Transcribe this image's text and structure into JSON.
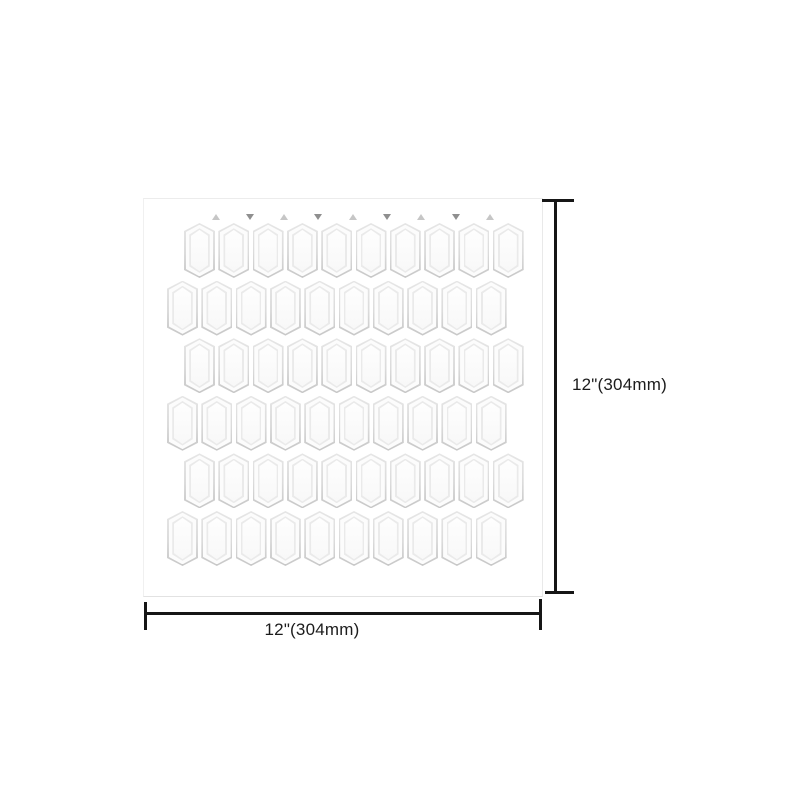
{
  "product": {
    "image_type": "tile-sheet-dimension-diagram",
    "dimension_labels": {
      "height": "12\"(304mm)",
      "width": "12\"(304mm)"
    }
  },
  "tile_sheet": {
    "rows": 6,
    "columns": 10,
    "tile_shape": "elongated-hexagon-picket",
    "markers": [
      "up",
      "down",
      "up",
      "down",
      "up",
      "down",
      "up",
      "down",
      "up"
    ],
    "colors": {
      "tile_fill": "#fcfcfc",
      "tile_border": "#d9d9d9",
      "tile_shadow": "#c7c7c7",
      "sheet_background": "#ffffff",
      "sheet_edge": "#e9e9e9",
      "marker_up": "#c6c6c6",
      "marker_down": "#8f8f8f",
      "dimension_line": "#161616",
      "label_text": "#1c1c1c"
    }
  }
}
